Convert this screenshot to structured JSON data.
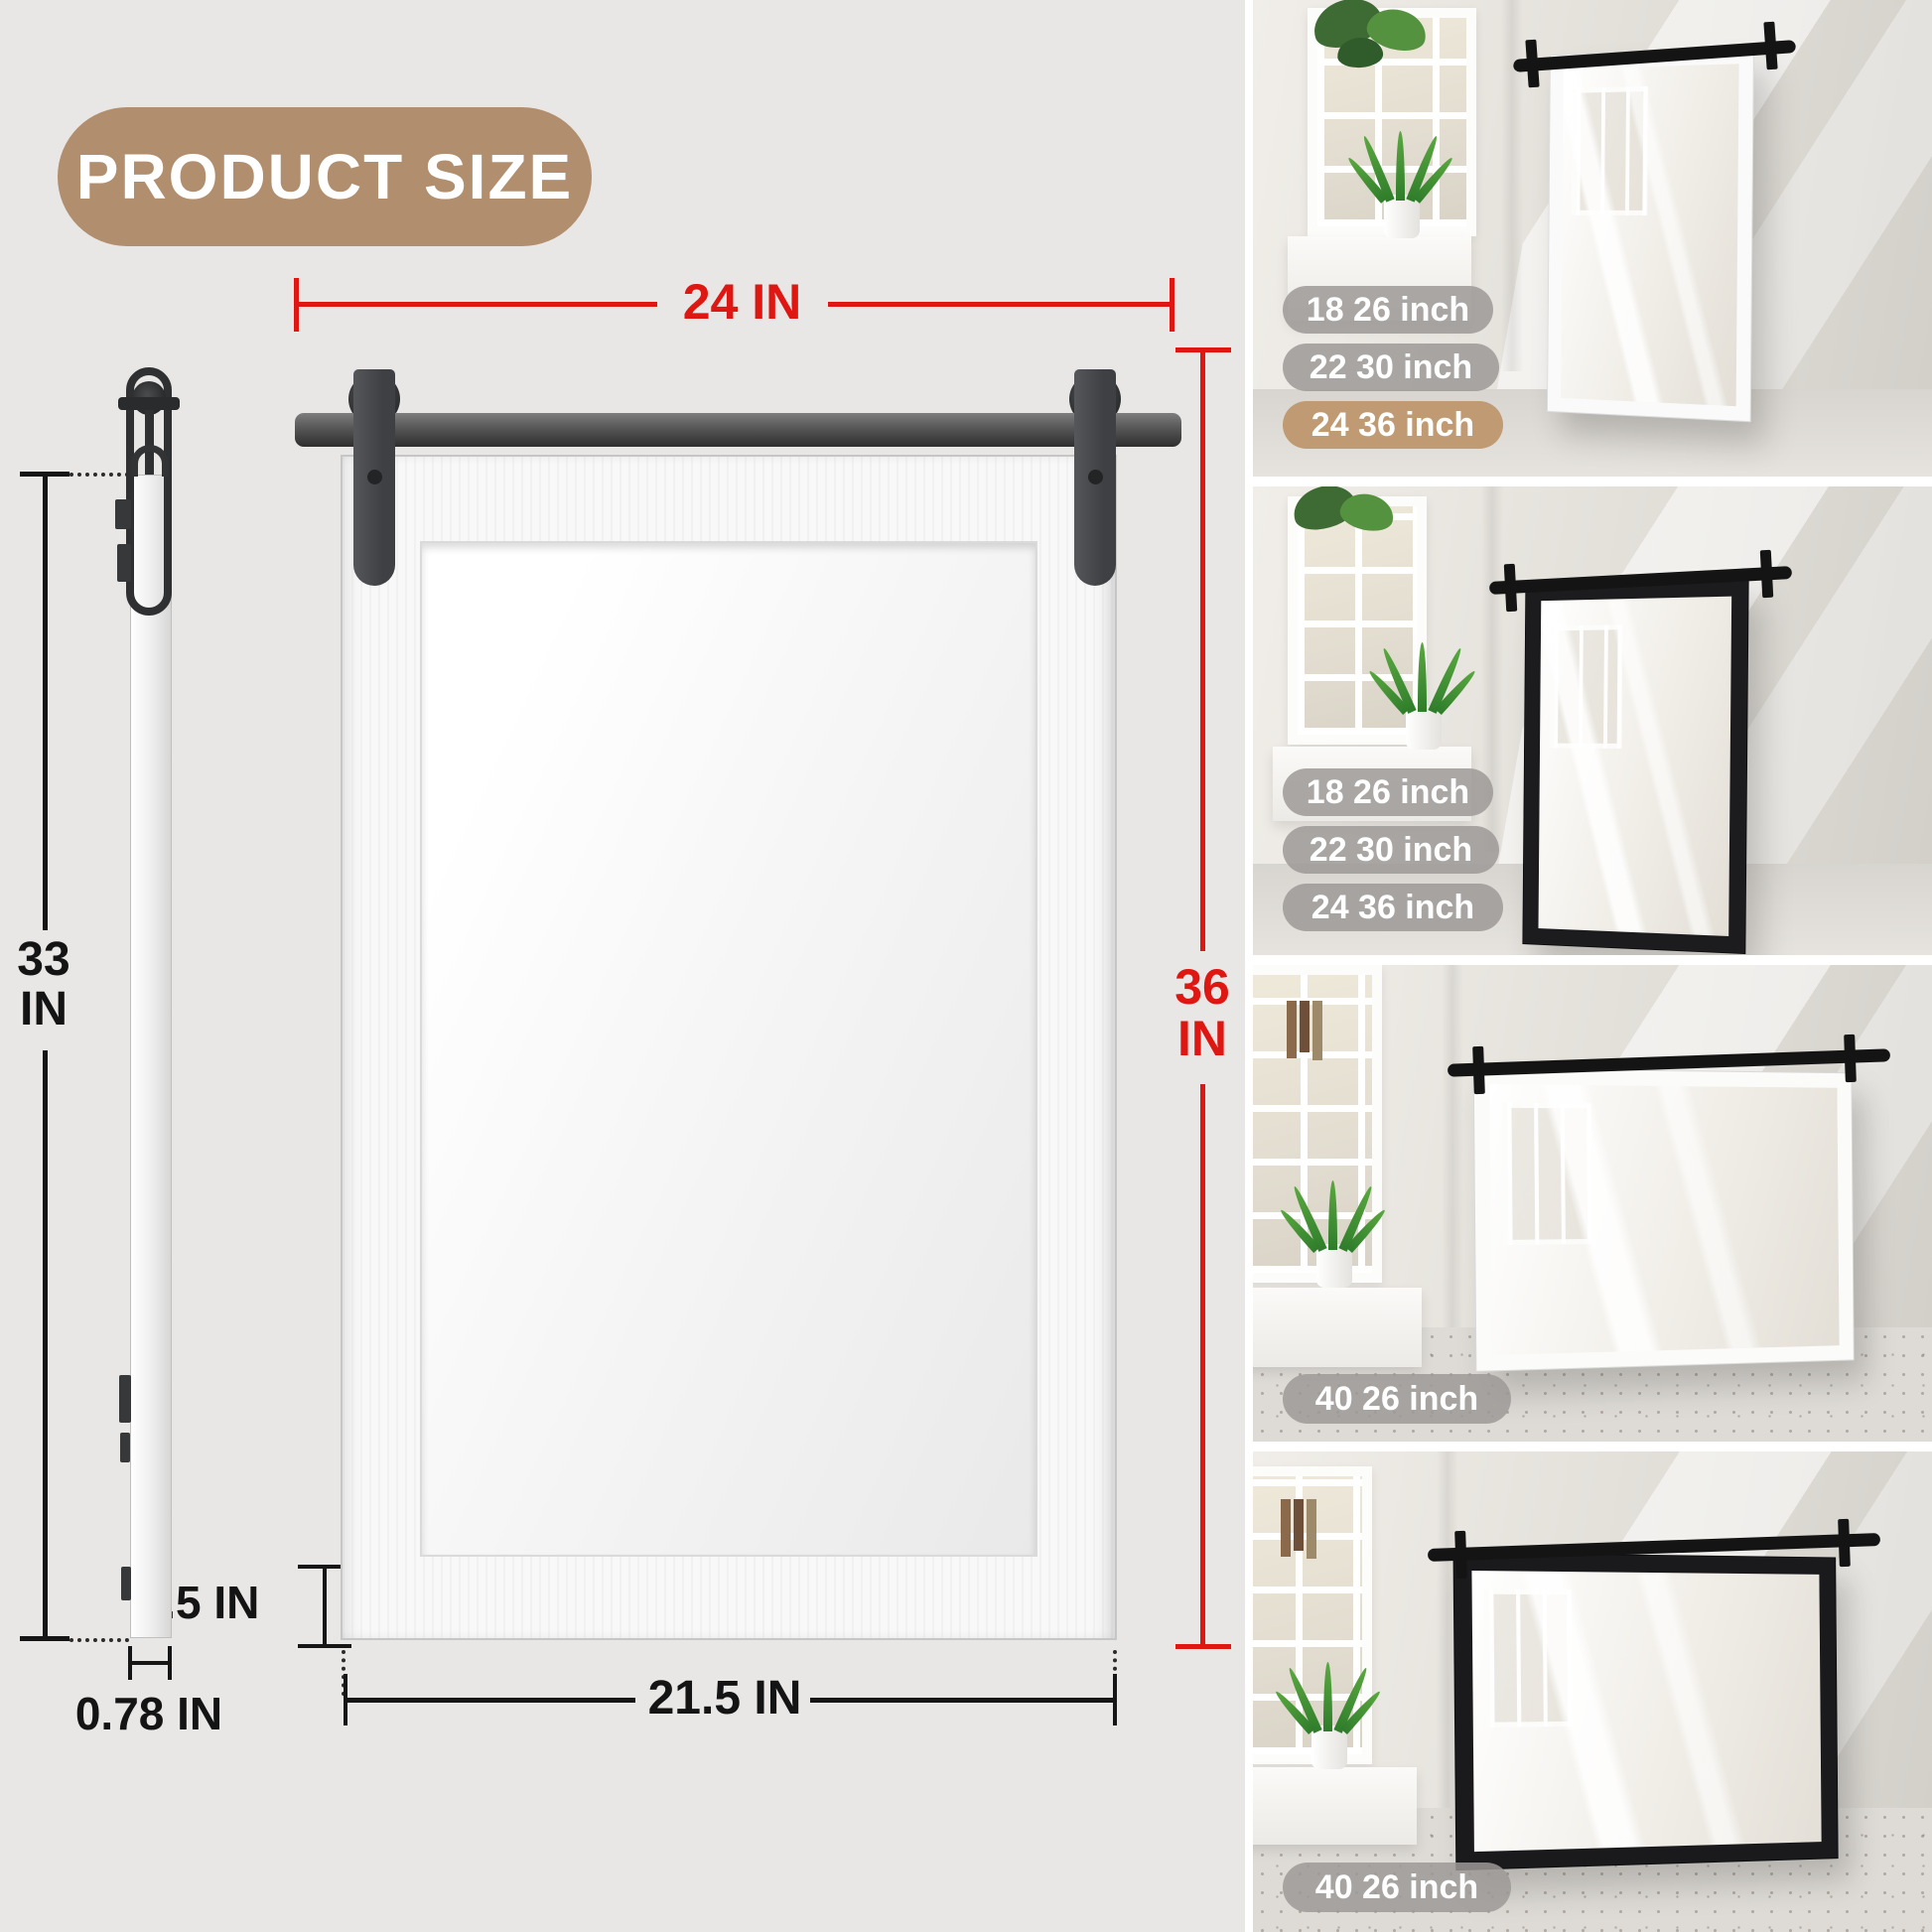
{
  "title": "PRODUCT SIZE",
  "colors": {
    "background": "#e9e7e5",
    "accent_red": "#de1712",
    "title_tan": "#b08e6e",
    "badge_gray": "#9c9996",
    "badge_highlight_tan": "#bf9a72",
    "dimension_black": "#141414"
  },
  "diagram": {
    "overall_width": "24 IN",
    "overall_height_value": "36",
    "overall_height_unit": "IN",
    "glass_width": "17.5 IN",
    "glass_height_value": "29.2",
    "glass_height_unit": "IN",
    "side_height_value": "33",
    "side_height_unit": "IN",
    "frame_thickness": "1.5 IN",
    "bottom_width": "21.5 IN",
    "depth": "0.78 IN"
  },
  "photos": [
    {
      "description": "white vertical barn-door mirror leaning on wall",
      "badges": [
        {
          "label": "18 26 inch",
          "highlight": false
        },
        {
          "label": "22 30 inch",
          "highlight": false
        },
        {
          "label": "24 36 inch",
          "highlight": true
        }
      ]
    },
    {
      "description": "black vertical barn-door mirror leaning on wall",
      "badges": [
        {
          "label": "18 26 inch",
          "highlight": false
        },
        {
          "label": "22 30 inch",
          "highlight": false
        },
        {
          "label": "24 36 inch",
          "highlight": false
        }
      ]
    },
    {
      "description": "white horizontal barn-door mirror leaning on wall",
      "badges": [
        {
          "label": "40 26 inch",
          "highlight": false
        }
      ]
    },
    {
      "description": "black horizontal barn-door mirror leaning on wall",
      "badges": [
        {
          "label": "40 26 inch",
          "highlight": false
        }
      ]
    }
  ]
}
